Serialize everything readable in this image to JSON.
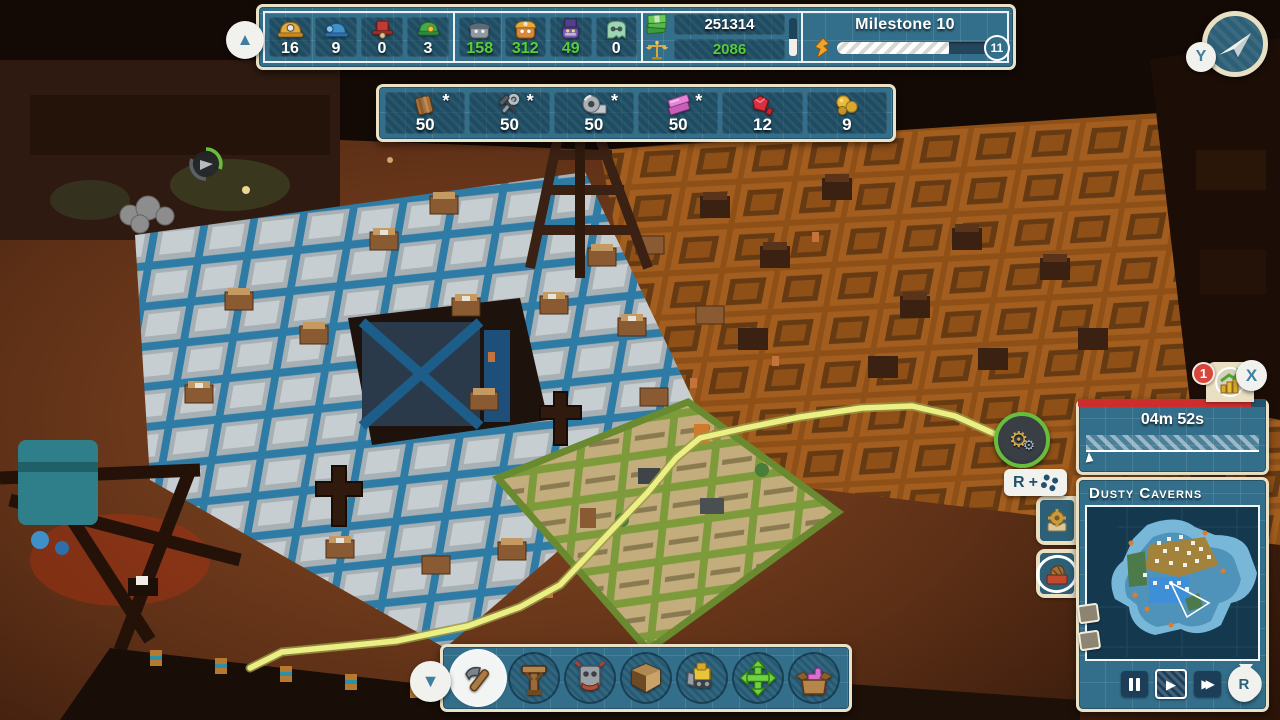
{
  "colors": {
    "panel_blue": "#336f8b",
    "panel_border": "#eae1c6",
    "accent_green": "#58cd38",
    "badge_red": "#d8453c",
    "alert_bar_red": "#cb2e2c",
    "path_yellow": "#ecef83"
  },
  "top_bar": {
    "workers": [
      {
        "icon": "miner-helmet-yellow",
        "value": "16"
      },
      {
        "icon": "worker-cap-blue",
        "value": "9"
      },
      {
        "icon": "worker-tophat-red",
        "value": "0"
      },
      {
        "icon": "worker-hat-green",
        "value": "3"
      }
    ],
    "population": [
      {
        "icon": "citizen-gray-cap",
        "value": "158"
      },
      {
        "icon": "citizen-orange-helmet",
        "value": "312"
      },
      {
        "icon": "citizen-purple-tophat",
        "value": "49"
      },
      {
        "icon": "citizen-green-bot",
        "value": "0"
      }
    ],
    "money": {
      "cash": "251314",
      "income": "2086"
    },
    "milestone": {
      "title": "Milestone 10",
      "next": "11",
      "progress_pct": 70
    }
  },
  "resource_bar": [
    {
      "icon": "planks",
      "value": "50",
      "star": "*"
    },
    {
      "icon": "tools",
      "value": "50",
      "star": "*"
    },
    {
      "icon": "steel-coil",
      "value": "50",
      "star": "*"
    },
    {
      "icon": "pink-ingot",
      "value": "50",
      "star": "*"
    },
    {
      "icon": "rubies",
      "value": "12",
      "star": ""
    },
    {
      "icon": "gold-nuggets",
      "value": "9",
      "star": ""
    }
  ],
  "prompts": {
    "y": "Y",
    "x": "X",
    "r": "R",
    "plus": "+",
    "rotate_r": "R",
    "badge_count": "1",
    "expand_up": "▲",
    "collapse_down": "▼"
  },
  "timer": {
    "remaining": "04m 52s"
  },
  "minimap": {
    "title": "Dusty Caverns"
  },
  "toolbar": {
    "tools": [
      "build-hammer",
      "support-post",
      "robot-head",
      "room-walls",
      "bulldozer",
      "move-arrows",
      "storage-box"
    ],
    "selected": "build-hammer"
  },
  "playback": {
    "selected": "play"
  }
}
